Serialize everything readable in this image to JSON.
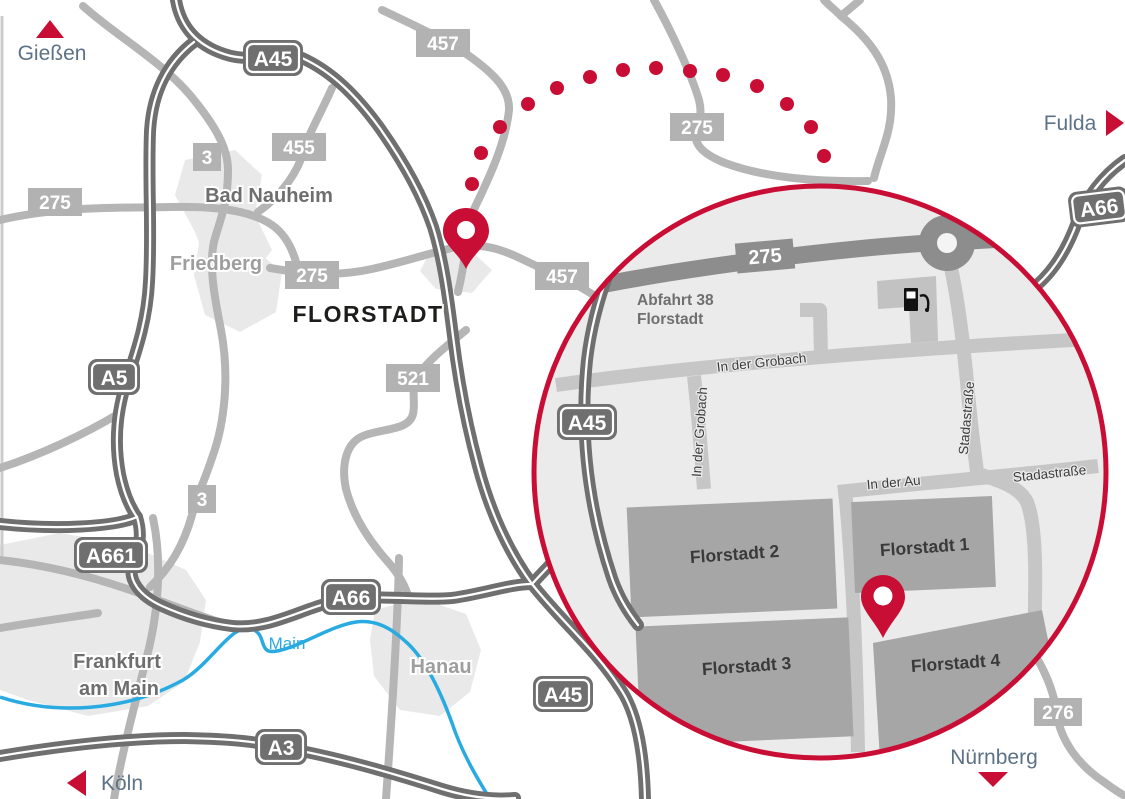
{
  "map_labels": {
    "giessen": "Gießen",
    "fulda": "Fulda",
    "koeln": "Köln",
    "nuernberg": "Nürnberg",
    "bad_nauheim": "Bad Nauheim",
    "friedberg": "Friedberg",
    "florstadt": "FLORSTADT",
    "frankfurt_line1": "Frankfurt",
    "frankfurt_line2": "am Main",
    "hanau": "Hanau",
    "river_main": "Main"
  },
  "badges": {
    "a45_north": "A45",
    "a45_south": "A45",
    "a5": "A5",
    "a661": "A661",
    "a66_west": "A66",
    "a66_east": "A66",
    "a3": "A3",
    "r275_west": "275",
    "r275_mid": "275",
    "r275_north": "275",
    "r455": "455",
    "r457_north": "457",
    "r457_mid": "457",
    "r521": "521",
    "r3_north": "3",
    "r3_south": "3",
    "r276": "276"
  },
  "inset": {
    "badge_275": "275",
    "badge_a45": "A45",
    "exit": {
      "line1": "Abfahrt 38",
      "line2": "Florstadt"
    },
    "streets": {
      "in_der_grobach_h": "In der Grobach",
      "in_der_grobach_v": "In der Grobach",
      "stadastrasse_v": "Stadastraße",
      "in_der_au": "In der Au",
      "stadastrasse_h": "Stadastraße"
    },
    "buildings": {
      "florstadt_1": "Florstadt 1",
      "florstadt_2": "Florstadt 2",
      "florstadt_3": "Florstadt 3",
      "florstadt_4": "Florstadt 4"
    },
    "icons": {
      "fuel_station": "fuel-station-icon",
      "roundabout": "roundabout-icon",
      "destination_pin": "location-pin"
    }
  },
  "colors": {
    "accent_red": "#c80e34",
    "highway_gray": "#6f6f6f",
    "road_gray": "#b5b5b5",
    "badge_gray": "#b2b2b2",
    "city_text_dark": "#6e6e6e",
    "city_text_light": "#9e9e9e",
    "direction_text": "#5e7287",
    "river_blue": "#29abe2",
    "inset_background": "#ebebeb",
    "inset_street": "#c6c6c6",
    "inset_road_dark": "#8d8d8d",
    "building_gray": "#a6a6a6",
    "florstadt_text": "#1d1d1b"
  }
}
